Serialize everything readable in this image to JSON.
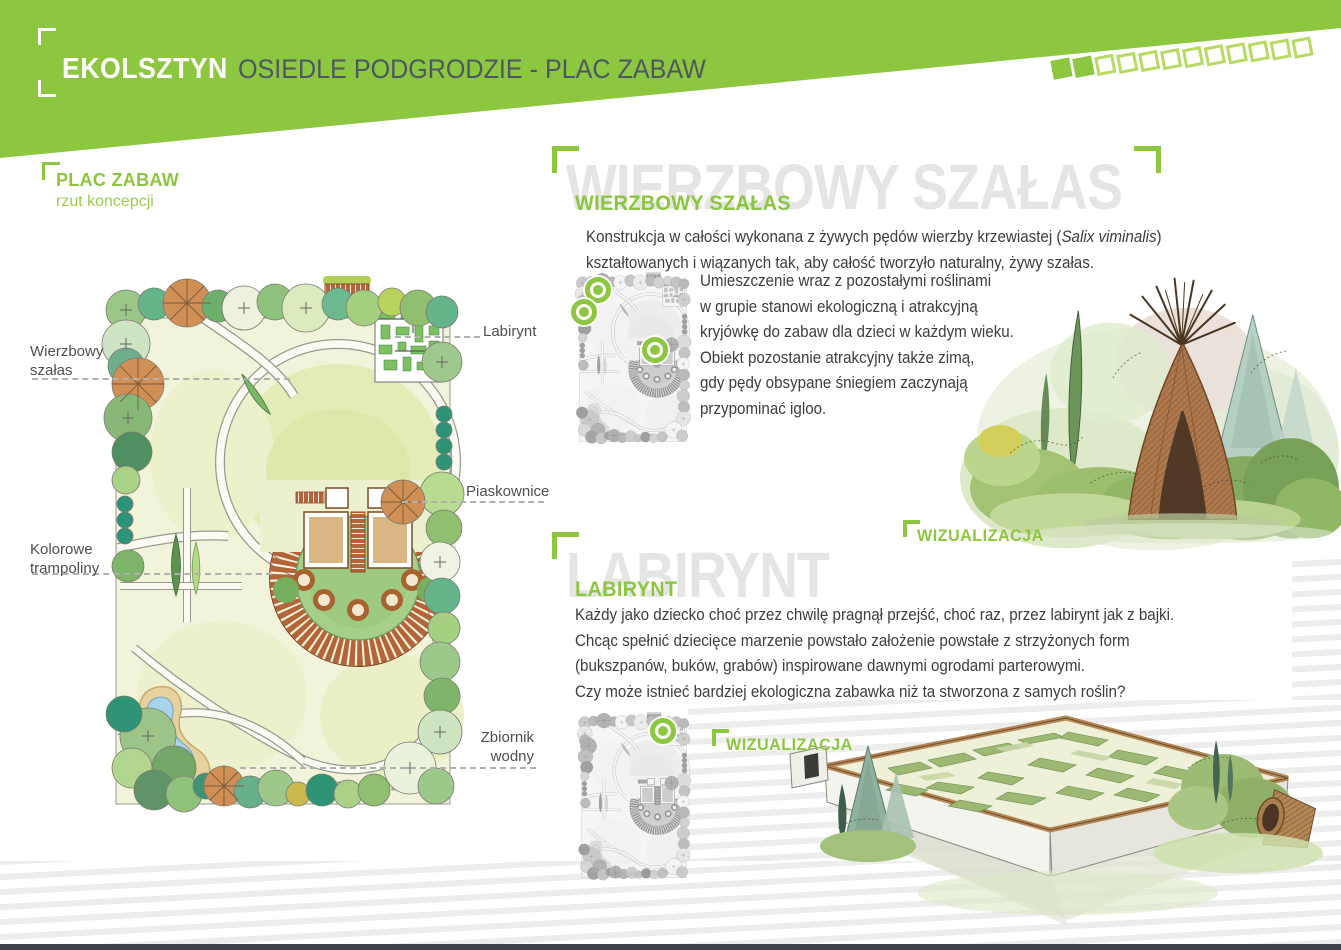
{
  "header": {
    "brand": "EKOLSZTYN",
    "subtitle": "OSIEDLE PODGRODZIE - PLAC ZABAW",
    "progress": {
      "filled": 2,
      "total": 12
    }
  },
  "accent_color": "#8dc63f",
  "plan": {
    "title": "PLAC ZABAW",
    "subtitle": "rzut koncepcji",
    "labels": {
      "labirynt": "Labirynt",
      "wierzbowy": "Wierzbowy szałas",
      "piaskownice": "Piaskownice",
      "trampoliny": "Kolorowe trampoliny",
      "zbiornik": "Zbiornik wodny"
    }
  },
  "sections": {
    "szalas": {
      "watermark": "WIERZBOWY SZAŁAS",
      "heading": "WIERZBOWY SZAŁAS",
      "para_before_italic": "Konstrukcja w całości wykonana z żywych pędów wierzby krzewiastej (",
      "para_italic": "Salix viminalis",
      "para_after_italic": ")",
      "para_line2": "kształtowanych i wiązanych tak, aby całość tworzyło naturalny,  żywy szałas.",
      "block_lines": [
        "Umieszczenie wraz z pozostałymi  roślinami",
        "w grupie stanowi ekologiczną  i atrakcyjną",
        "kryjówkę do zabaw dla dzieci w każdym wieku.",
        "Obiekt pozostanie atrakcyjny także zimą,",
        "gdy pędy obsypane śniegiem zaczynają",
        "przypominać igloo."
      ],
      "viz_label": "WIZUALIZACJA"
    },
    "labirynt": {
      "watermark": "LABIRYNT",
      "heading": "LABIRYNT",
      "lines": [
        "Każdy jako dziecko choć przez chwilę pragnął przejść, choć raz, przez labirynt jak z bajki.",
        "Chcąc spełnić dziecięce marzenie powstało założenie powstałe z strzyżonych form",
        "(bukszpanów, buków, grabów) inspirowane dawnymi ogrodami parterowymi.",
        "Czy może istnieć bardziej ekologiczna zabawka niż ta stworzona z samych roślin?"
      ],
      "viz_label": "WIZUALIZACJA"
    }
  }
}
